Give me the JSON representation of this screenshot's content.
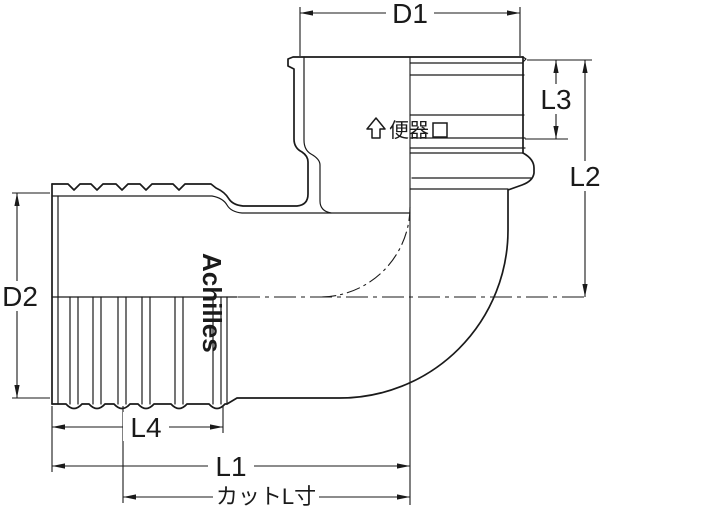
{
  "figure": {
    "type": "technical-drawing",
    "subject": "90-degree toilet elbow pipe fitting, half-section view",
    "colors": {
      "line": "#1a1a1a",
      "background": "#ffffff"
    }
  },
  "dimensions": {
    "d1": "D1",
    "d2": "D2",
    "l1": "L1",
    "l2": "L2",
    "l3": "L3",
    "l4": "L4",
    "cut_length": "カットL寸"
  },
  "markings": {
    "brand": "Achilles",
    "orientation_label": "便器",
    "orientation_arrow_icon": "hollow-up-arrow",
    "orientation_box_icon": "small-square"
  }
}
